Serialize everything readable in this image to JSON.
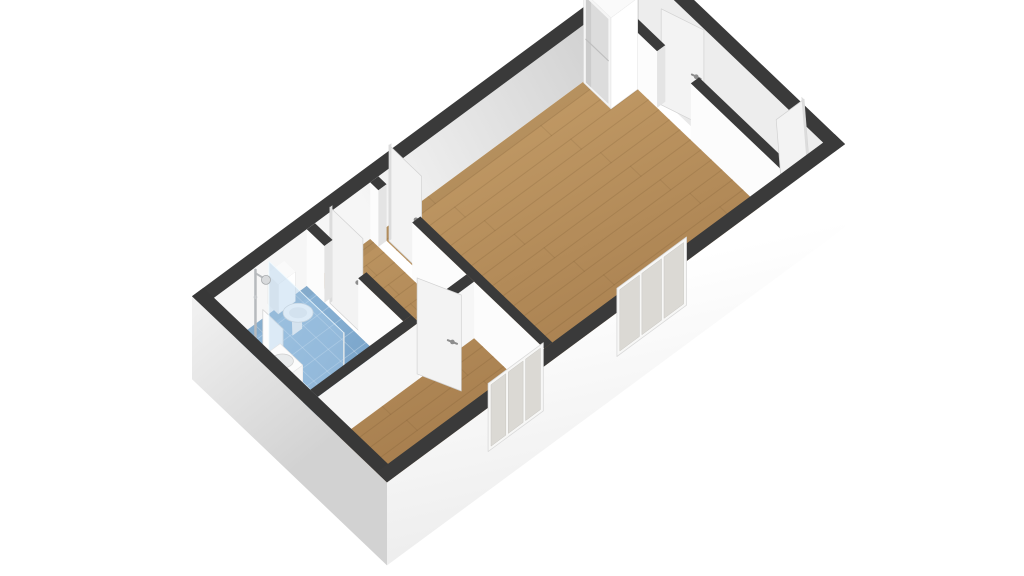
{
  "meta": {
    "kind": "3d-floorplan-render",
    "background": "#ffffff"
  },
  "projection": {
    "origin": [
      387,
      539
    ],
    "axis_x_px": [
      40.9,
      -30.2
    ],
    "axis_y_px": [
      -37.5,
      -35.8
    ],
    "z_px": 48
  },
  "palette": {
    "cap": "#3a3a3a",
    "cap_dark": "#383838",
    "wall_white": "#fcfcfc",
    "wall_light": "#f6f6f6",
    "wall_gray": "#ededed",
    "jamb": "#e4e4e4",
    "door_face": "#f3f3f3",
    "door_edge": "#d2d2d2",
    "door_side": "#dcdcdc",
    "handle": "#8d8d8d",
    "hall_floor_1": "#f0f0f0",
    "hall_floor_2": "#dcdcdc",
    "wood_light": "#c59e69",
    "wood_dark": "#a07748",
    "wood_streak": "rgba(99,69,36,0.17)",
    "tile_light": "#93badb",
    "tile_dark": "#6b98c0",
    "tile_grid": "rgba(255,255,255,0.30)",
    "shower_overlay": "rgba(30,70,115,0.16)",
    "glass_fill": "rgba(173,208,235,0.42)",
    "glass_edge": "rgba(240,250,255,0.85)",
    "window_glass": "#dbd9d4",
    "window_frame": "#f7f7f6",
    "chrome": "#b7babd",
    "ext_far_1": "#f6f6f6",
    "ext_far_2": "#c7c7c7",
    "ext_left_1": "#f1f1f1",
    "ext_left_2": "#d2d2d2",
    "ext_front_1": "#ffffff",
    "ext_front_2": "#ebebeb",
    "far_shadow": "rgba(0,0,0,0.045)"
  },
  "building": {
    "width_m": 11.2,
    "depth_m": 5.2,
    "wall_height_m": 1.18,
    "ext_thickness_m": 0.28,
    "base_drop_m": 0.55
  },
  "rooms": [
    {
      "name": "living-room-floor",
      "floor": "wood",
      "rect": [
        4.3,
        0.28,
        9.95,
        4.92
      ]
    },
    {
      "name": "entrance-hall-floor",
      "floor": "hall",
      "rect": [
        10.15,
        0.28,
        10.92,
        4.92
      ]
    },
    {
      "name": "hallway-floor",
      "floor": "wood",
      "rect": [
        2.75,
        2.35,
        4.1,
        4.92
      ]
    },
    {
      "name": "bathroom-floor",
      "floor": "tile",
      "rect": [
        0.28,
        2.35,
        2.55,
        4.92
      ]
    },
    {
      "name": "bedroom-floor",
      "floor": "wood",
      "rect": [
        0.28,
        0.28,
        4.1,
        2.15
      ]
    }
  ],
  "walls": [
    {
      "name": "exterior-wall-far",
      "rect": [
        0,
        4.92,
        11.2,
        5.2
      ],
      "face": "-y",
      "fill": "gradFar"
    },
    {
      "name": "exterior-wall-right",
      "rect": [
        10.92,
        0,
        11.2,
        5.2
      ],
      "face": "-x",
      "fill": "#ededed"
    },
    {
      "name": "wall-living-hall",
      "rect": [
        9.95,
        0.28,
        10.15,
        4.92
      ],
      "face": "-x",
      "fill": "#fcfcfc",
      "opening": {
        "axis": "y",
        "a0": 2.75,
        "a1": 3.65
      }
    },
    {
      "name": "wall-living-left",
      "rect": [
        4.1,
        0.28,
        4.3,
        4.92
      ],
      "face": "-x",
      "fill": "#fcfcfc",
      "opening": {
        "axis": "y",
        "a0": 3.8,
        "a1": 4.7
      }
    },
    {
      "name": "wall-bathroom-right",
      "rect": [
        2.55,
        2.35,
        2.75,
        4.92
      ],
      "face": "-x",
      "fill": "#fcfcfc",
      "opening": {
        "axis": "y",
        "a0": 3.55,
        "a1": 4.45
      }
    },
    {
      "name": "wall-bedroom-top",
      "rect": [
        0.28,
        2.15,
        4.1,
        2.35
      ],
      "face": "-y",
      "fill": "#f6f6f6",
      "opening": {
        "axis": "x",
        "a0": 2.75,
        "a1": 3.6
      }
    },
    {
      "name": "exterior-wall-left",
      "rect": [
        0,
        0,
        0.28,
        5.2
      ],
      "face": "outer-x",
      "fill": "gradLeft"
    },
    {
      "name": "exterior-wall-front",
      "rect": [
        0,
        0,
        11.2,
        0.28
      ],
      "face": "outer-y",
      "fill": "gradFront"
    }
  ],
  "doors": [
    {
      "name": "door-living-hall",
      "kind": "swing",
      "hinge": [
        10.05,
        3.65
      ],
      "dir": [
        0.32,
        -0.947
      ],
      "len": 0.88,
      "height": 2.0,
      "handle": 0.82
    },
    {
      "name": "entry-door",
      "kind": "tilted",
      "y": 0.55,
      "x0": 10.2,
      "x1": 10.88,
      "tilt_dx": -0.18,
      "height": 2.02
    },
    {
      "name": "door-living-room",
      "kind": "flat-x",
      "x": 4.33,
      "y0": 3.8,
      "y1": 4.67,
      "height": 2.0,
      "handle_y": 3.95
    },
    {
      "name": "door-bathroom",
      "kind": "flat-x",
      "x": 2.62,
      "y0": 3.5,
      "y1": 4.38,
      "height": 2.0,
      "handle_y": 3.64
    },
    {
      "name": "door-bedroom",
      "kind": "swing",
      "hinge": [
        2.8,
        2.25
      ],
      "dir": [
        0.42,
        -0.91
      ],
      "len": 0.86,
      "height": 2.0,
      "handle": 0.8
    }
  ],
  "windows": [
    {
      "name": "window-bedroom",
      "a0": 2.6,
      "a1": 3.95,
      "z0": 0.08,
      "z1": 1.5,
      "panes": 3
    },
    {
      "name": "window-living-room",
      "a0": 5.75,
      "a1": 7.45,
      "z0": 0.08,
      "z1": 1.5,
      "panes": 3
    }
  ],
  "fixtures": [
    {
      "type": "wardrobe",
      "name": "wardrobe",
      "rect": [
        9.3,
        4.17,
        9.95,
        4.9
      ],
      "height": 1.9
    },
    {
      "type": "mirror",
      "name": "bathroom-mirror",
      "x": 0.32,
      "y0": 3.12,
      "y1": 3.66,
      "z0": 1.05,
      "z1": 1.85
    },
    {
      "type": "toilet",
      "name": "toilet",
      "cx": 1.75,
      "cy": 4.4
    },
    {
      "type": "glass-screen",
      "name": "shower-glass",
      "x": 1.1,
      "y0": 2.35,
      "y1": 4.35,
      "height": 1.85
    },
    {
      "type": "sink",
      "name": "bathroom-sink",
      "rect": [
        0.34,
        3.1,
        0.78,
        3.7
      ],
      "height": 0.82
    },
    {
      "type": "shower-column",
      "name": "shower-column",
      "x": 1.02,
      "y": 4.62,
      "height": 1.52
    }
  ],
  "draw_order": [
    "wall:exterior-wall-far",
    "wall:exterior-wall-right",
    "room:entrance-hall-floor",
    "door:door-living-hall",
    "wall:wall-living-hall",
    "door:entry-door",
    "room:living-room-floor",
    "fix:wardrobe",
    "door:door-living-room",
    "wall:wall-living-left",
    "room:hallway-floor",
    "room:bathroom-floor",
    "fix:bathroom-mirror",
    "fix:toilet",
    "fix:shower-glass",
    "fix:bathroom-sink",
    "fix:shower-column",
    "door:door-bathroom",
    "wall:wall-bathroom-right",
    "wall:wall-bedroom-top",
    "room:bedroom-floor",
    "door:door-bedroom",
    "wall:exterior-wall-left",
    "wall:exterior-wall-front",
    "win:window-bedroom",
    "win:window-living-room"
  ]
}
